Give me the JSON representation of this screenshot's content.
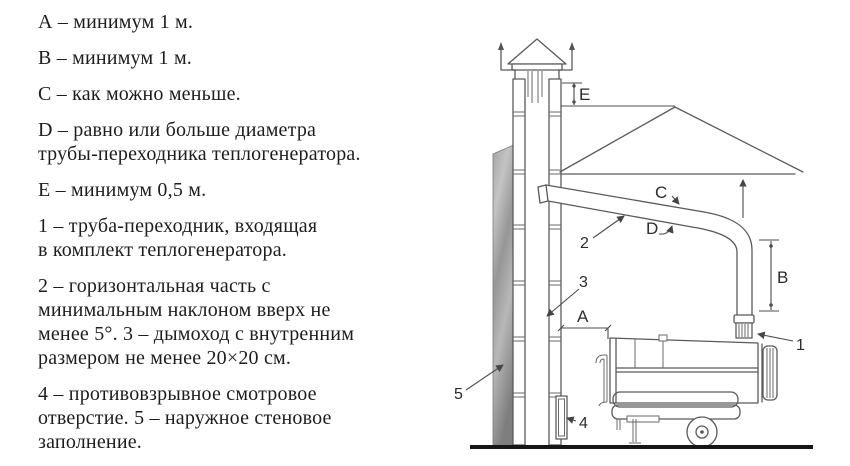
{
  "legend": {
    "paragraphs": [
      {
        "lines": [
          "А – минимум 1 м."
        ]
      },
      {
        "lines": [
          "В – минимум 1 м."
        ]
      },
      {
        "lines": [
          "С – как можно меньше."
        ]
      },
      {
        "lines": [
          "D – равно или больше диаметра",
          "трубы-переходника теплогенератора."
        ]
      },
      {
        "lines": [
          "Е – минимум 0,5 м."
        ]
      },
      {
        "lines": [
          "1 – труба-переходник, входящая",
          "в комплект теплогенератора."
        ]
      },
      {
        "lines": [
          "2 – горизонтальная часть с",
          "минимальным наклоном вверх не",
          "менее 5°. 3 – дымоход с внутренним",
          "размером не менее 20×20 см."
        ]
      },
      {
        "lines": [
          "4 – противовзрывное смотровое",
          "отверстие. 5 – наружное стеновое",
          "заполнение."
        ]
      }
    ]
  },
  "diagram": {
    "labels": {
      "A": "А",
      "B": "В",
      "C": "С",
      "D": "D",
      "E": "Е",
      "n1": "1",
      "n2": "2",
      "n3": "3",
      "n4": "4",
      "n5": "5"
    },
    "colors": {
      "line": "#5a5a5a",
      "label": "#2b2b2b",
      "ground": "#161616",
      "wall_dark": "#808080",
      "wall_light": "#c4c4c4",
      "background": "#ffffff"
    }
  }
}
